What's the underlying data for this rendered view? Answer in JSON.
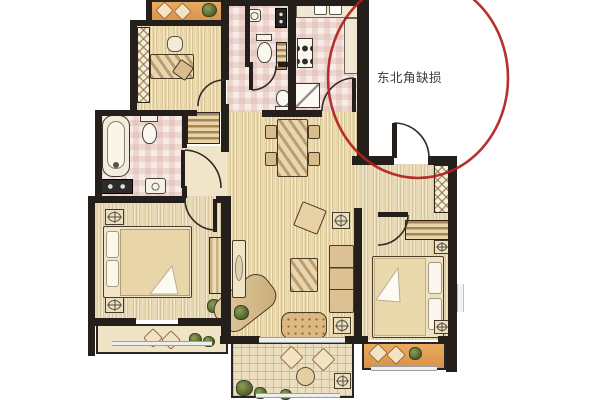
{
  "annotation": {
    "text": "东北角缺损"
  },
  "colors": {
    "wall": "#241f1a",
    "annotation_red": "#b11e1e",
    "annotation_text": "#3a3a3a",
    "wood_floor": "#e9d8ac",
    "tile_pink_base": "#f6ebe6",
    "tile_pink_check": "#d9a79c",
    "balcony_orange_1": "#eaab60",
    "balcony_orange_2": "#d9914a",
    "balcony_pale": "#f0e4c6",
    "balcony_grid": "#ecdfc0",
    "window_frame": "#9aa0a4",
    "plant_green": "#4c5c2b"
  }
}
